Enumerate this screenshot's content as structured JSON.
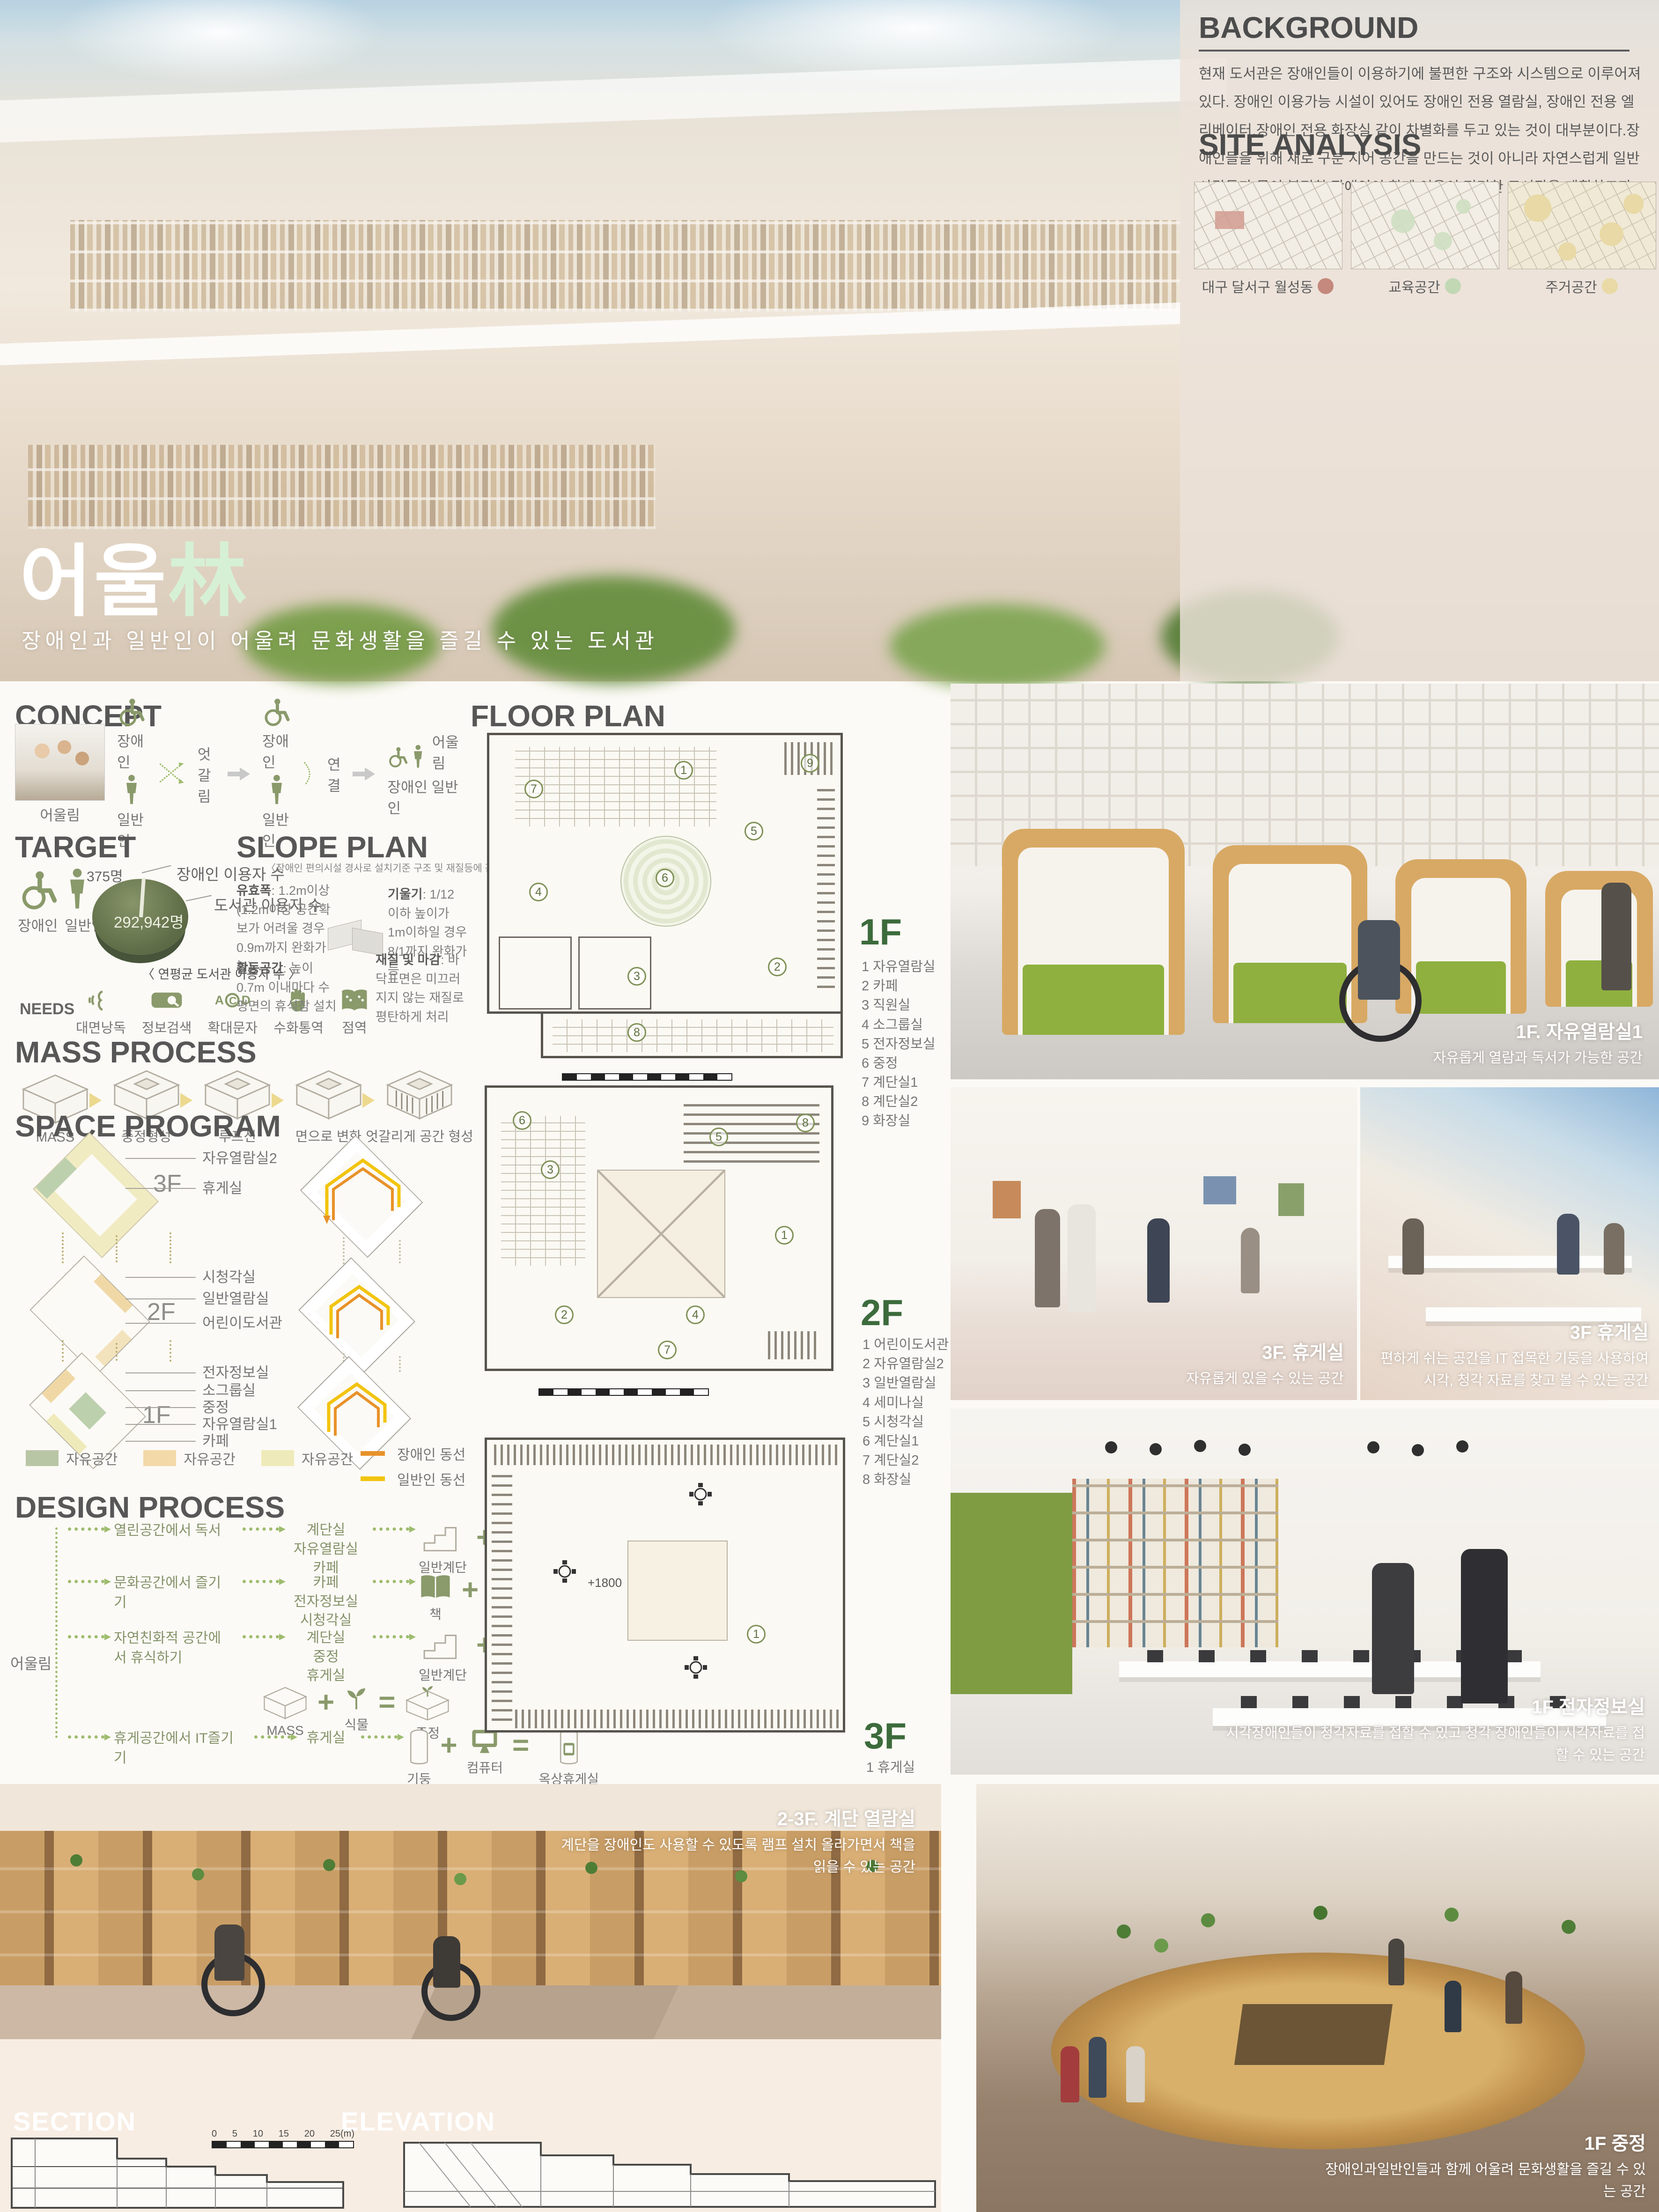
{
  "accent": {
    "olive": "#8a9a6b",
    "mint": "#d6f0d6",
    "orange": "#e8922a",
    "yellow": "#f2c40f"
  },
  "hero": {
    "title_main": "어울",
    "title_accent": "林",
    "subtitle": "장애인과 일반인이 어울려 문화생활을 즐길 수 있는 도서관",
    "background": {
      "heading": "BACKGROUND",
      "body": "현재 도서관은 장애인들이 이용하기에 불편한 구조와 시스템으로 이루어져있다. 장애인 이용가능 시설이 있어도 장애인 전용 열람실, 장애인 전용 엘리베이터,장애인 전용 화장실 같이 차별화를 두고 있는 것이 대부분이다.장애인들을 위해 새로 구분 지어 공간을 만드는 것이 아니라 자연스럽게 일반 사람들과 몸이 불편한 장애인이 함께 이용이 편리한 도서관을 계획하고자 한다."
    },
    "site_analysis": {
      "heading": "SITE ANALYSIS",
      "maps": [
        {
          "label": "대구 달서구 월성동",
          "dot_color": "#c4897c"
        },
        {
          "label": "교육공간",
          "dot_color": "#c2d8b5"
        },
        {
          "label": "주거공간",
          "dot_color": "#e9d9a4"
        }
      ]
    }
  },
  "concept": {
    "heading": "CONCEPT",
    "photo_label": "어울림",
    "label_disabled": "장애인",
    "label_general": "일반인",
    "label_cross": "엇갈림",
    "label_connect": "연결",
    "label_merge": "어울림",
    "label_merge_sub": "장애인  일반인"
  },
  "target": {
    "heading": "TARGET",
    "label_disabled": "장애인",
    "label_general": "일반인",
    "pie": {
      "small_value": "375명",
      "small_label": "장애인 이용자 수",
      "big_value": "292,942명",
      "big_label": "도서관 이용자 수",
      "caption": "〈 연평균 도서관  이용자 수 〉"
    },
    "needs_label": "NEEDS",
    "needs": [
      "대면낭독",
      "정보검색",
      "확대문자",
      "수화통역",
      "점역"
    ]
  },
  "slope_plan": {
    "heading": "SLOPE PLAN",
    "subtitle": "〈장애인  편의시설 경사로 설치기준 구조 및 재질등에 관한 세부사항〉",
    "notes": [
      {
        "title": "유효폭",
        "text": ": 1.2m이상 (1.2m이상 공간확보가 어려울 경우 0.9m까지 완화가능)"
      },
      {
        "title": "기울기",
        "text": ": 1/12 이하 높이가 1m이하일 경우 8/1까지 완화가능"
      },
      {
        "title": "활동공간",
        "text": ": 높이 0.7m 이내마다 수평면의 휴식참 설치"
      },
      {
        "title": "재질 및 마감",
        "text": ": 바닥표면은 미끄러지지 않는 재질로 평탄하게 처리"
      }
    ]
  },
  "mass_process": {
    "heading": "MASS PROCESS",
    "steps": [
      "MASS",
      "중정형성",
      "루프선",
      "면으로 변화",
      "엇갈리게 공간 형성"
    ]
  },
  "space_program": {
    "heading": "SPACE PROGRAM",
    "floors": [
      {
        "name": "3F",
        "rooms": [
          "자유열람실2",
          "휴게실"
        ]
      },
      {
        "name": "2F",
        "rooms": [
          "시청각실",
          "일반열람실",
          "어린이도서관"
        ]
      },
      {
        "name": "1F",
        "rooms": [
          "전자정보실",
          "소그룹실",
          "중정",
          "자유열람실1",
          "카페"
        ]
      }
    ],
    "legend": [
      {
        "label": "자유공간",
        "color": "#b9c6a6"
      },
      {
        "label": "자유공간",
        "color": "#f3d9a7"
      },
      {
        "label": "자유공간",
        "color": "#efeab9"
      }
    ],
    "paths": [
      {
        "label": "장애인 동선",
        "color": "#e8922a"
      },
      {
        "label": "일반인 동선",
        "color": "#f2c40f"
      }
    ]
  },
  "design_process": {
    "heading": "DESIGN PROCESS",
    "root": "어울림",
    "rows": [
      {
        "activity": "열린공간에서 독서",
        "spaces": [
          "계단실",
          "자유열람실",
          "카페"
        ],
        "a": "일반계단",
        "b": "움직임 (공간 분할)",
        "result": "엇갈리는 층"
      },
      {
        "activity": "문화공간에서 즐기기",
        "spaces": [
          "카페",
          "전자정보실",
          "시청각실"
        ],
        "a": "책",
        "b": "카페",
        "result": "북카페"
      },
      {
        "activity": "자연친화적 공간에서 휴식하기",
        "spaces": [
          "계단실",
          "중정",
          "휴게실"
        ],
        "a": "일반계단",
        "b": "식물",
        "result": "자연친화적계단",
        "a2": "MASS",
        "b2": "식물",
        "result2": "중정"
      },
      {
        "activity": "휴게공간에서 IT즐기기",
        "spaces": [
          "휴게실"
        ],
        "a": "기둥",
        "b": "컴퓨터",
        "result": "옥상휴게실"
      }
    ]
  },
  "floor_plan": {
    "heading": "FLOOR PLAN",
    "floors": [
      {
        "name": "1F",
        "legend": [
          "1 자유열람실",
          "2 카페",
          "3 직원실",
          "4 소그룹실",
          "5 전자정보실",
          "6 중정",
          "7 계단실1",
          "8 계단실2",
          "9 화장실"
        ],
        "badges": [
          "1",
          "2",
          "3",
          "4",
          "5",
          "6",
          "7",
          "8",
          "9"
        ]
      },
      {
        "name": "2F",
        "legend": [
          "1 어린이도서관",
          "2 자유열람실2",
          "3 일반열람실",
          "4 세미나실",
          "5 시청각실",
          "6 계단실1",
          "7 계단실2",
          "8 화장실"
        ],
        "badges": [
          "1",
          "2",
          "3",
          "4",
          "5",
          "6",
          "7",
          "8"
        ]
      },
      {
        "name": "3F",
        "legend": [
          "1 휴게실"
        ],
        "badges": [
          "1"
        ],
        "annotation": "+1800"
      }
    ]
  },
  "renders": {
    "reading_room": {
      "title": "1F. 자유열람실1",
      "caption": "자유롭게 열람과 독서가 가능한 공간"
    },
    "lounge_left": {
      "title": "3F. 휴게실",
      "caption": "자유롭게 있을 수 있는 공간"
    },
    "lounge_right": {
      "title": "3F 휴게실",
      "caption": "편하게 쉬는 공간을 IT 접목한 기둥을 사용하여 시각, 청각 자료를 찾고 볼 수 있는 공간"
    },
    "digital_room": {
      "title": "1F 전자정보실",
      "caption": "시각장애인들이 청각자료를 접할 수 있고 청각 장애인들이 시각자료를 접할 수 있는 공간"
    },
    "stair_reading": {
      "title": "2-3F. 계단 열람실",
      "caption": "계단을 장애인도 사용할 수 있도록 램프 설치 올라가면서 책을 읽을 수 있는 공간"
    },
    "courtyard": {
      "title": "1F 중정",
      "caption": "장애인과일반인들과 함께 어울려 문화생활을 즐길 수 있는 공간"
    }
  },
  "drawings": {
    "section_label": "SECTION",
    "elevation_label": "ELEVATION",
    "scale_ticks": [
      "0",
      "5",
      "10",
      "15",
      "20",
      "25(m)"
    ]
  }
}
